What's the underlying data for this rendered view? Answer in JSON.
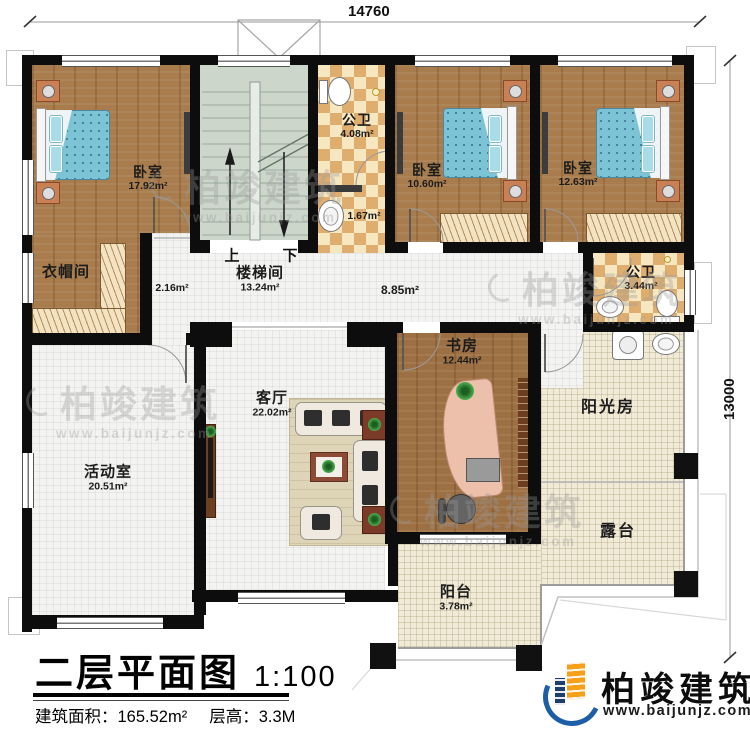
{
  "dimensions": {
    "top": "14760",
    "right": "13000"
  },
  "rooms": {
    "bedroom1": {
      "name": "卧室",
      "area": "17.92m²"
    },
    "bedroom2": {
      "name": "卧室",
      "area": "10.60m²"
    },
    "bedroom3": {
      "name": "卧室",
      "area": "12.63m²"
    },
    "cloakroom": {
      "name": "衣帽间"
    },
    "hall_small": {
      "area": "2.16m²"
    },
    "stairwell": {
      "name": "楼梯间",
      "area": "13.24m²"
    },
    "stair_up": "上",
    "stair_down": "下",
    "bath_top": {
      "name": "公卫",
      "area": "4.08m²"
    },
    "bath_top_annex": {
      "area": "1.67m²"
    },
    "corridor": {
      "area": "8.85m²"
    },
    "bath_right": {
      "name": "公卫",
      "area": "3.44m²"
    },
    "study": {
      "name": "书房",
      "area": "12.44m²"
    },
    "living": {
      "name": "客厅",
      "area": "22.02m²"
    },
    "activity": {
      "name": "活动室",
      "area": "20.51m²"
    },
    "sunroom": {
      "name": "阳光房"
    },
    "terrace": {
      "name": "露台"
    },
    "balcony": {
      "name": "阳台",
      "area": "3.78m²"
    }
  },
  "title_block": {
    "title": "二层平面图",
    "scale": "1:100",
    "area": "建筑面积：165.52m²",
    "floor_height": "层高：3.3M"
  },
  "branding": {
    "company": "柏竣建筑",
    "website": "www.baijunjz.com"
  },
  "watermark": {
    "text": "柏竣建筑",
    "url": "www.baijunjz.com"
  }
}
